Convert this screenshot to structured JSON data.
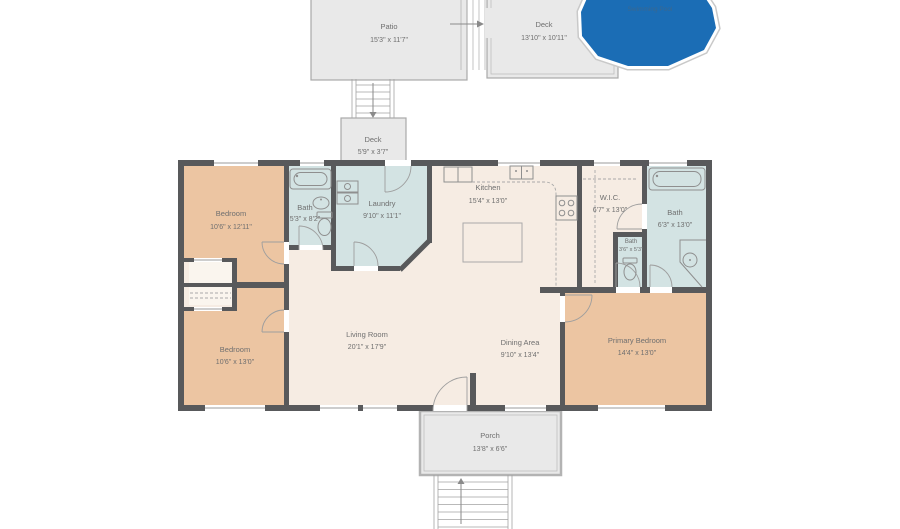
{
  "floorplan": {
    "outdoor": {
      "patio": {
        "name": "Patio",
        "dims": "15'3\" x 11'7\""
      },
      "deck_upper": {
        "name": "Deck",
        "dims": "13'10\" x 10'11\""
      },
      "pool": {
        "name": "Swimming Pool"
      },
      "deck_lower": {
        "name": "Deck",
        "dims": "5'9\" x 3'7\""
      },
      "porch": {
        "name": "Porch",
        "dims": "13'8\" x 6'6\""
      }
    },
    "rooms": {
      "bedroom_top_left": {
        "name": "Bedroom",
        "dims": "10'6\" x 12'11\""
      },
      "bath_top_left": {
        "name": "Bath",
        "dims": "5'3\" x 8'2\""
      },
      "laundry": {
        "name": "Laundry",
        "dims": "9'10\" x 11'1\""
      },
      "kitchen": {
        "name": "Kitchen",
        "dims": "15'4\" x 13'0\""
      },
      "wic": {
        "name": "W.I.C.",
        "dims": "6'7\" x 13'0\""
      },
      "bath_right": {
        "name": "Bath",
        "dims": "6'3\" x 13'0\""
      },
      "bath_small": {
        "name": "Bath",
        "dims": "3'6\" x 5'3\""
      },
      "living_room": {
        "name": "Living Room",
        "dims": "20'1\" x 17'9\""
      },
      "dining_area": {
        "name": "Dining Area",
        "dims": "9'10\" x 13'4\""
      },
      "bedroom_bottom_left": {
        "name": "Bedroom",
        "dims": "10'6\" x 13'0\""
      },
      "primary_bedroom": {
        "name": "Primary Bedroom",
        "dims": "14'4\" x 13'0\""
      }
    },
    "colors": {
      "wall": "#58595b",
      "bedroom_fill": "#ecc5a2",
      "wet_room_fill": "#d3e3e3",
      "living_fill": "#f6ece3",
      "outdoor_fill": "#e9e9e9",
      "outdoor_border": "#a9a9a9",
      "pool_fill": "#1b6db5",
      "label_text": "#6f6f6f",
      "pool_label_text": "#3b688f"
    }
  }
}
